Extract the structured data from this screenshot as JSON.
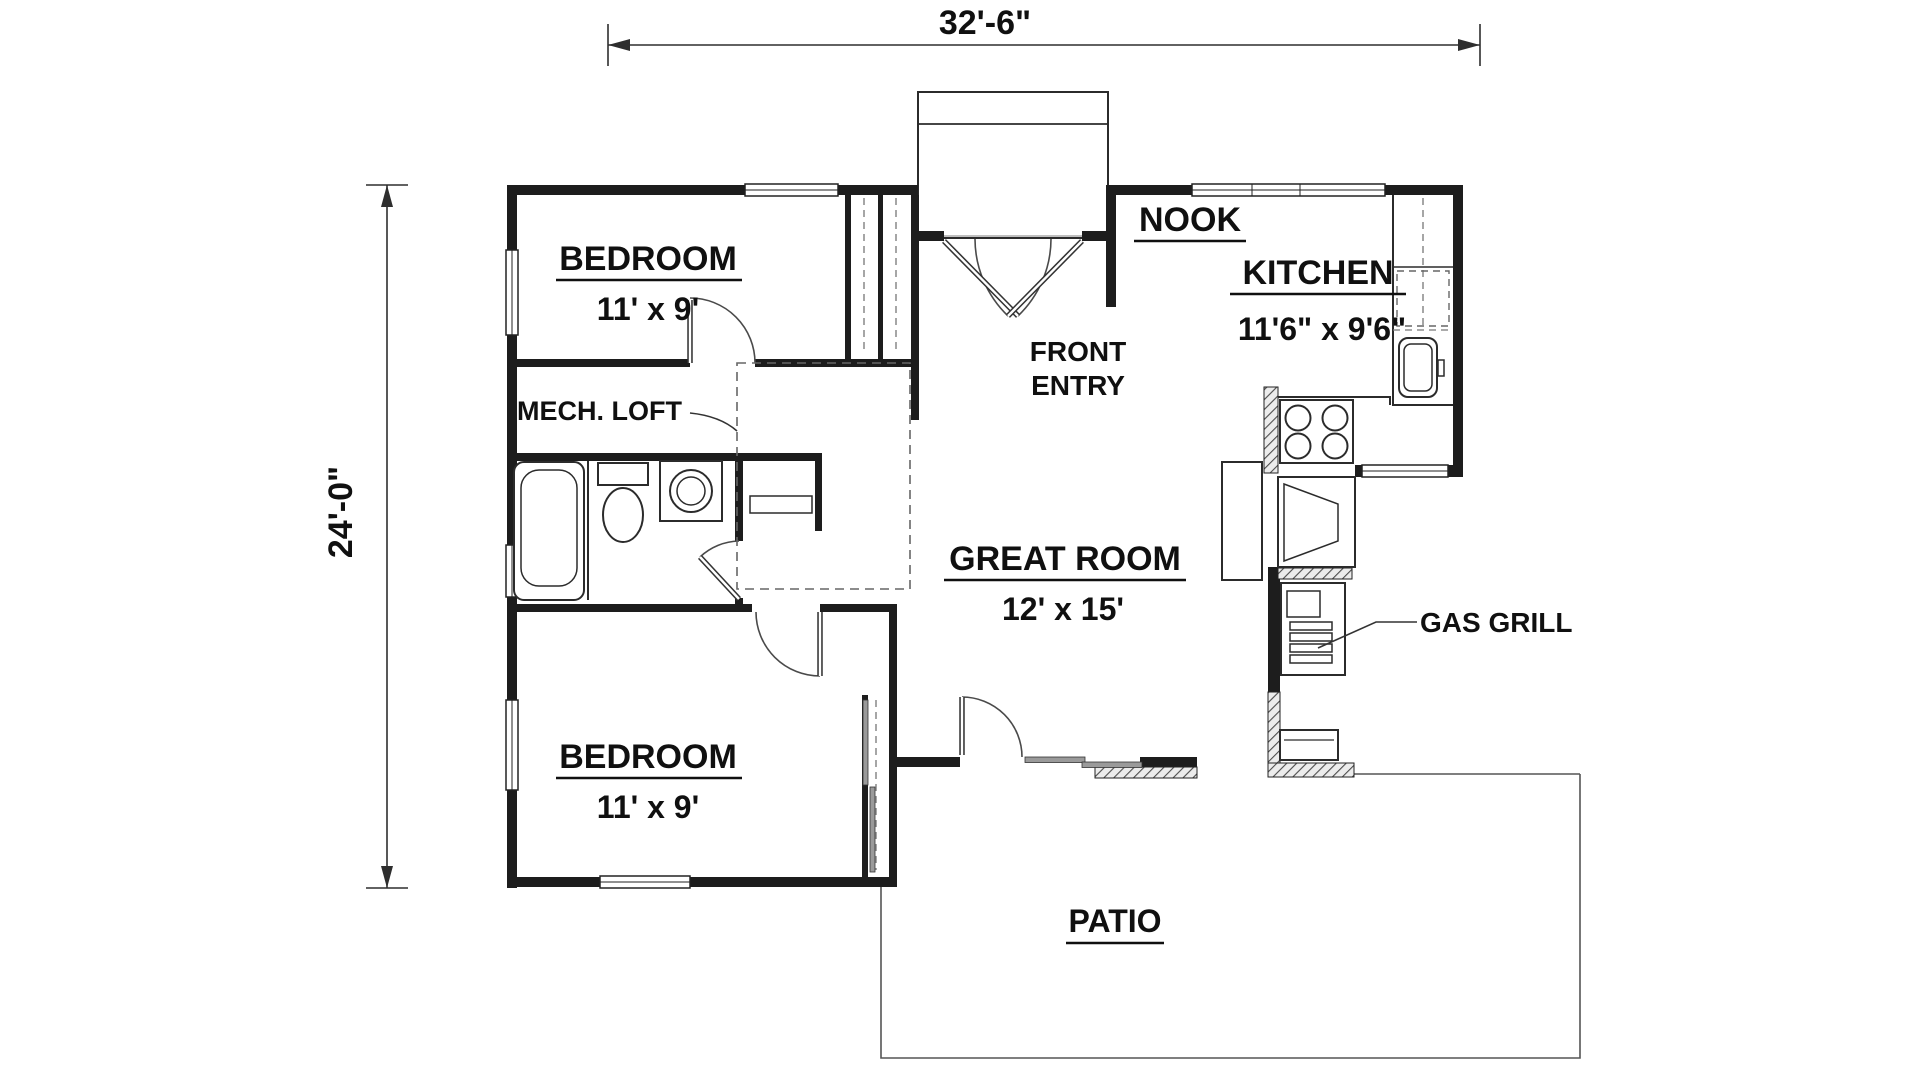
{
  "dimensions": {
    "width_label": "32'-6\"",
    "height_label": "24'-0\""
  },
  "rooms": {
    "bedroom_top": {
      "label": "BEDROOM",
      "size": "11' x 9'"
    },
    "bedroom_bottom": {
      "label": "BEDROOM",
      "size": "11' x 9'"
    },
    "nook": {
      "label": "NOOK"
    },
    "kitchen": {
      "label": "KITCHEN",
      "size": "11'6\" x 9'6\""
    },
    "great_room": {
      "label": "GREAT ROOM",
      "size": "12' x 15'"
    },
    "front_entry": {
      "line1": "FRONT",
      "line2": "ENTRY"
    },
    "mech_loft": {
      "label": "MECH. LOFT"
    },
    "gas_grill": {
      "label": "GAS GRILL"
    },
    "patio": {
      "label": "PATIO"
    }
  },
  "fixtures": [
    "bathtub",
    "toilet",
    "washer",
    "linen-shelf",
    "kitchen-sink",
    "refrigerator",
    "range-burners",
    "fireplace",
    "gas-grill",
    "sliding-glass-door",
    "entry-porch",
    "double-entry-door"
  ],
  "colors": {
    "wall": "#1d1d1d",
    "text": "#101010",
    "line": "#555555",
    "background": "#ffffff"
  }
}
